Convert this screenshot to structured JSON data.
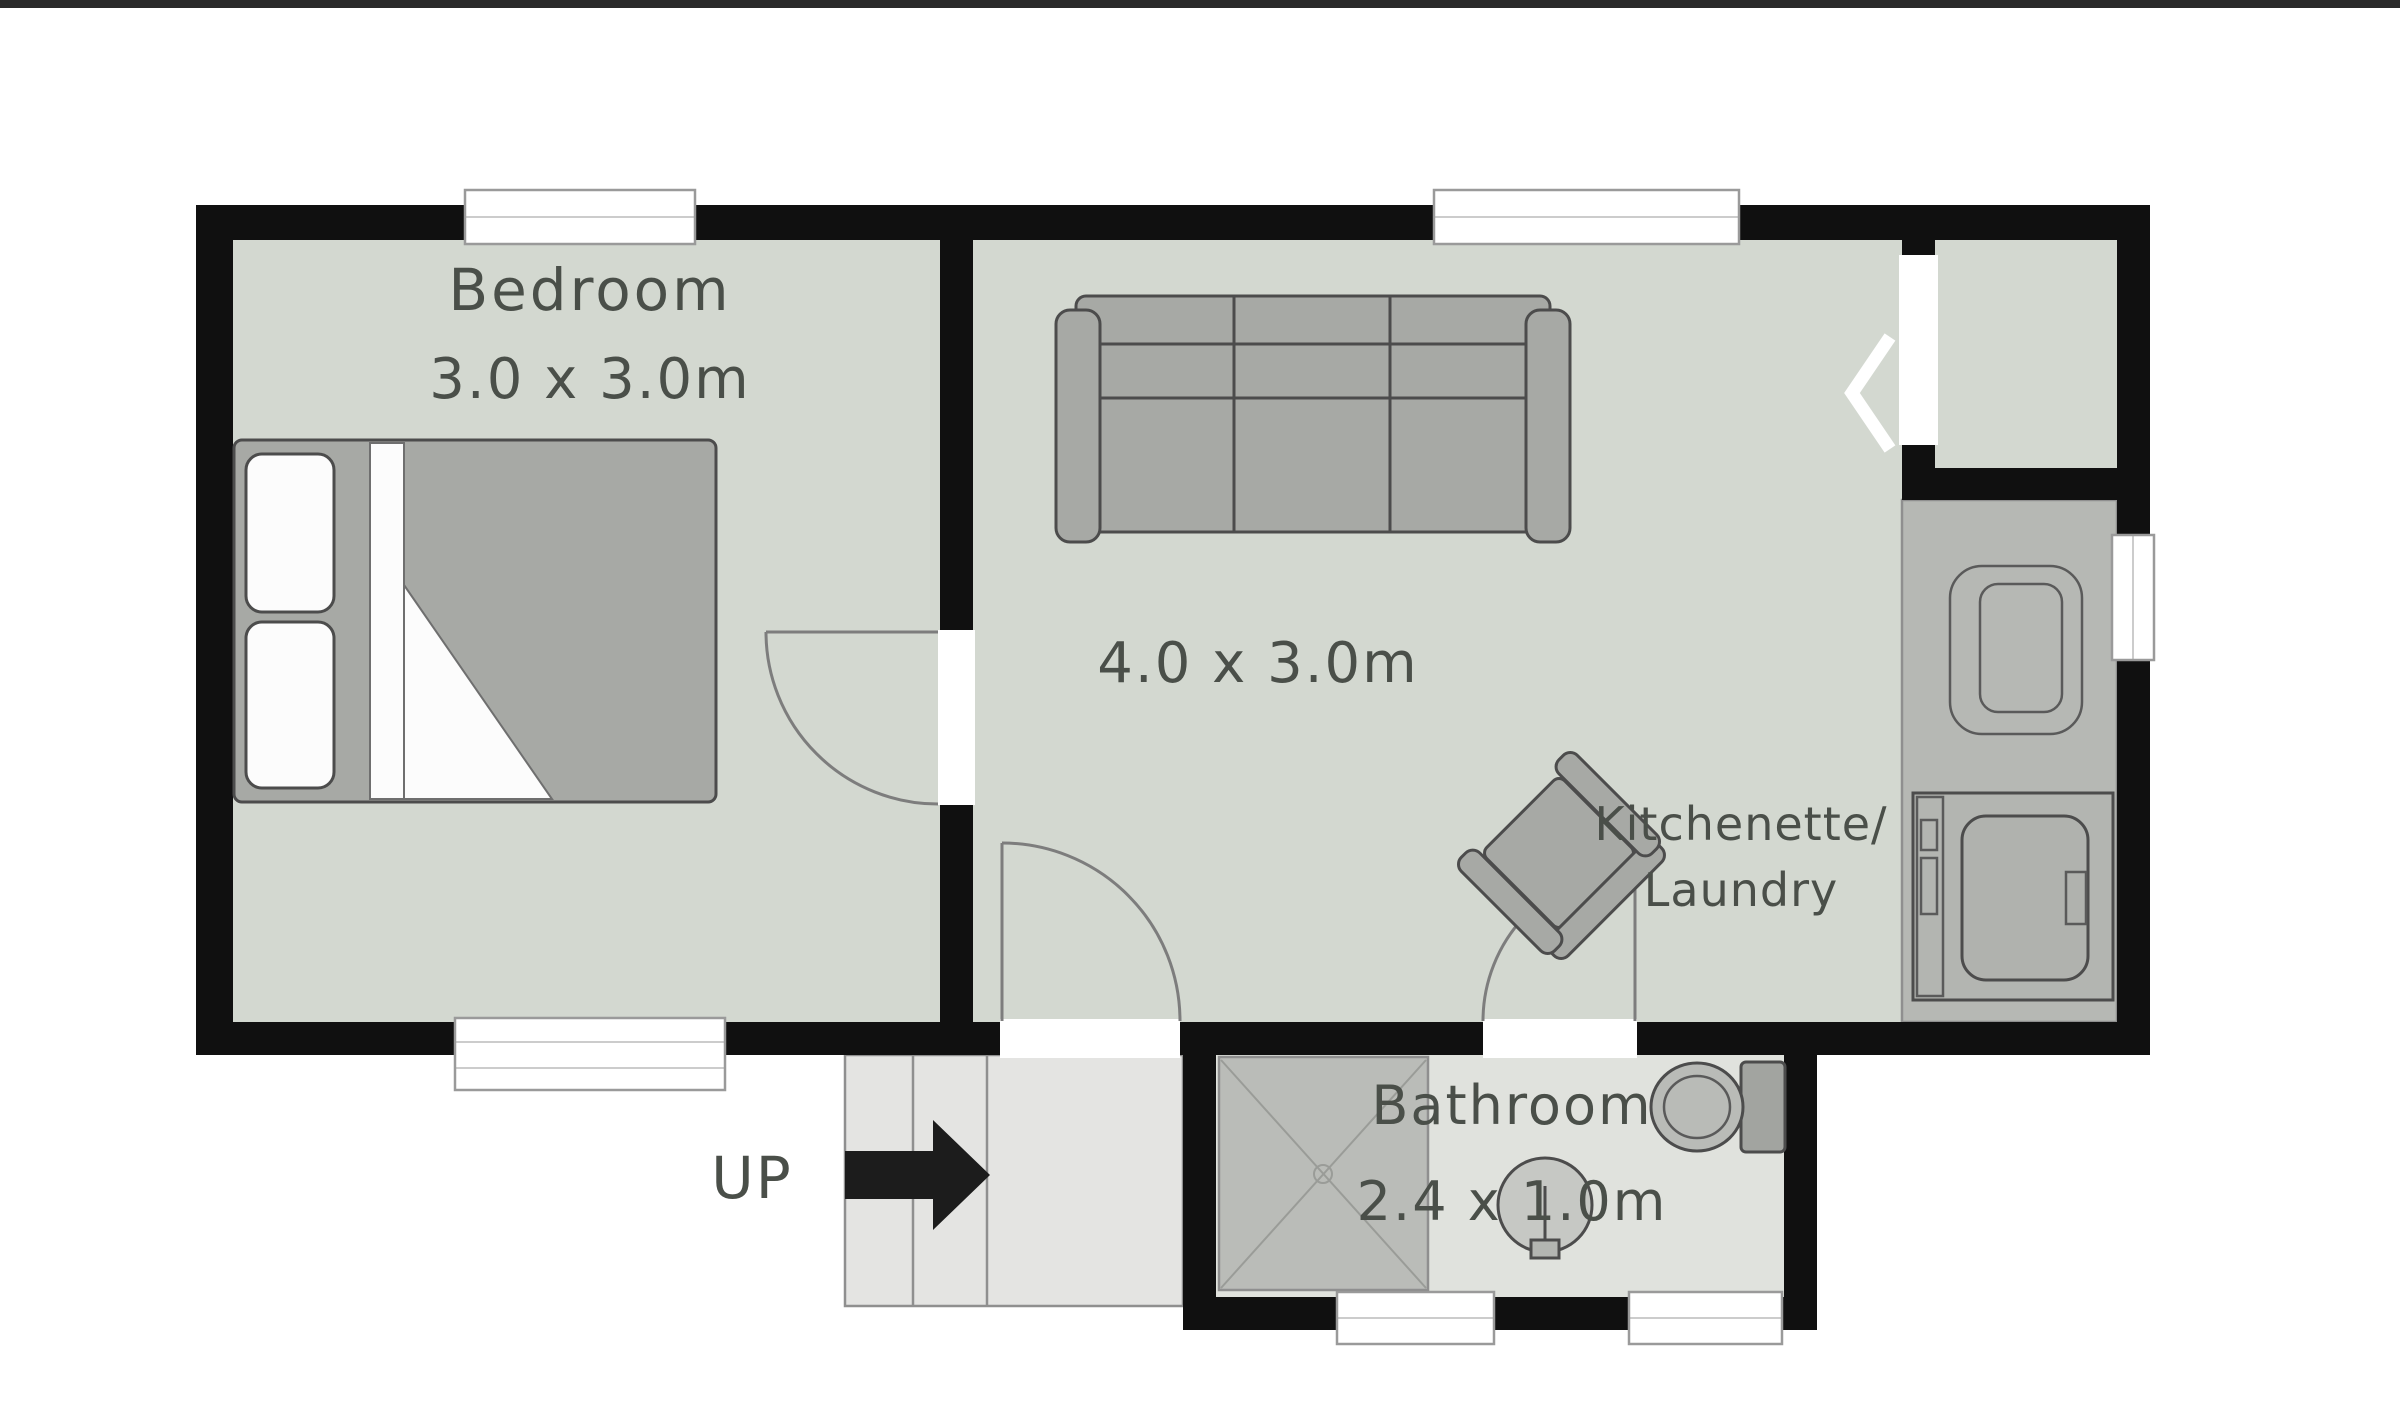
{
  "plan": {
    "rooms": {
      "bedroom": {
        "label": "Bedroom",
        "dims": "3.0 x 3.0m"
      },
      "living": {
        "dims": "4.0 x 3.0m"
      },
      "kitchenette": {
        "label_line1": "Kitchenette/",
        "label_line2": "Laundry"
      },
      "bathroom": {
        "label": "Bathroom",
        "dims": "2.4 x 1.0m"
      },
      "stairs": {
        "label": "UP"
      }
    },
    "colors": {
      "top_bar": "#2a2a2a",
      "wall": "#101010",
      "floor_main": "#d3d8d0",
      "floor_bathroom": "#e0e2dd",
      "floor_stairs": "#e4e4e2",
      "counter": "#b6b8b4",
      "shower": "#babcb8",
      "furniture_fill": "#a7a9a5",
      "furniture_stroke": "#4c4c4c",
      "pillow": "#fcfcfc",
      "door_arc": "#7d7d7d",
      "window_frame": "#9a9a9a",
      "arrow": "#1c1c1c",
      "text": "#4a4f49",
      "chevron": "#ffffff"
    }
  }
}
